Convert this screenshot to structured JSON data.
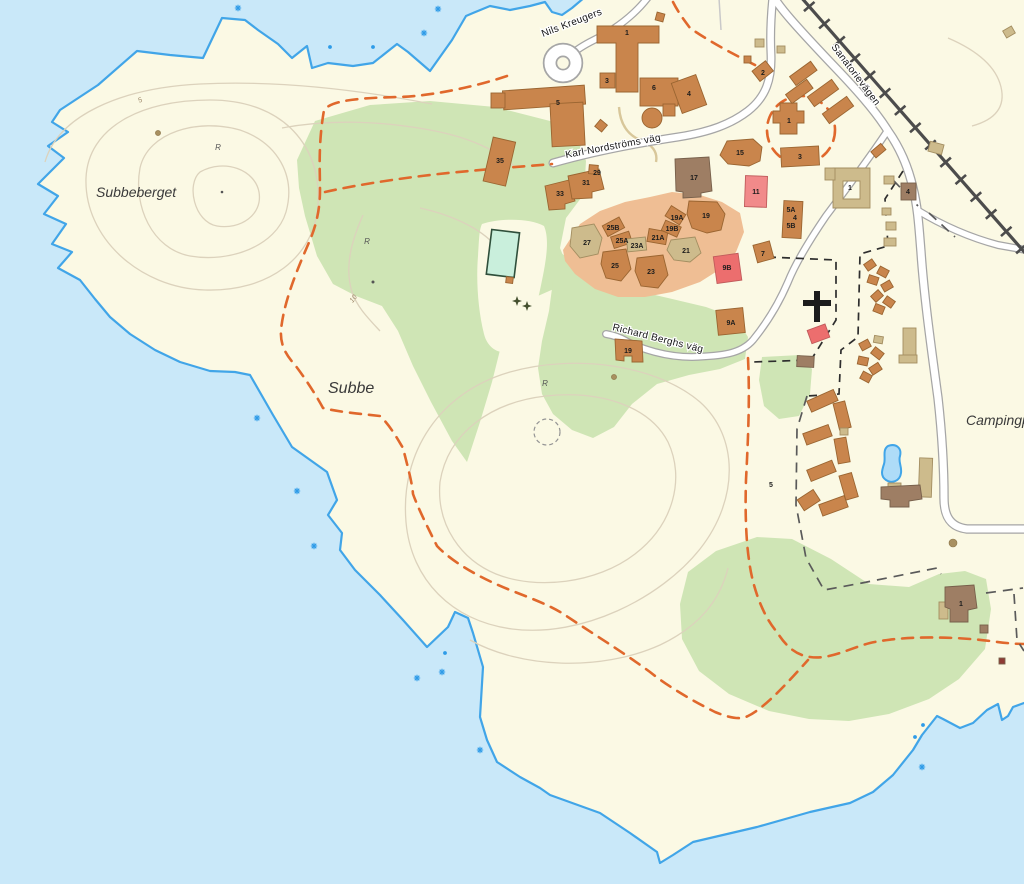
{
  "map": {
    "description": "Topographic town map of the Subbe peninsula with sanatorium area, camping ground and railway",
    "zoom_hint": "street-level"
  },
  "colors": {
    "water": "#C9E8F9",
    "land": "#FBF9E4",
    "green": "#CFE5B5",
    "residential_zone": "#EFBE94",
    "building_orange": "#C9854C",
    "building_orange_stroke": "#9A6531",
    "building_tan": "#CDBB8C",
    "building_tan_stroke": "#A38E61",
    "building_brown": "#9E7E64",
    "building_brown_stroke": "#77604B",
    "building_pink": "#F18A8A",
    "building_red": "#EC6E6E",
    "building_pink_stroke": "#C05B5B",
    "road_fill": "#FFFFFF",
    "road_casing": "#A6A6A6",
    "railway": "#4C4C4C",
    "trail": "#E0682C",
    "contour": "#DCD2BC",
    "coastline": "#41A5E8",
    "pool": "#C9EFDC",
    "pond": "#AEDCF8",
    "label": "#1C1C1C",
    "contour_label": "#9C8668"
  },
  "labels": {
    "places": [
      {
        "text": "Subbeberget",
        "x": 96,
        "y": 197,
        "big": false
      },
      {
        "text": "Subbe",
        "x": 328,
        "y": 393,
        "big": true
      },
      {
        "text": "Campingp",
        "x": 966,
        "y": 425,
        "big": false
      }
    ],
    "streets": [
      {
        "text": "Nils Kreugers",
        "x": 543,
        "y": 37,
        "rot": -21
      },
      {
        "text": "Karl Nordströms väg",
        "x": 566,
        "y": 158,
        "rot": -10.5
      },
      {
        "text": "Richard Berghs väg",
        "x": 612,
        "y": 330,
        "rot": 14
      },
      {
        "text": "Sanatorievägen",
        "x": 831,
        "y": 47,
        "rot": 53
      }
    ],
    "contour_labels": [
      {
        "text": "5",
        "x": 141,
        "y": 102,
        "rot": -25
      },
      {
        "text": "10",
        "x": 355,
        "y": 300,
        "rot": -52
      }
    ],
    "terrain_marks": [
      {
        "text": "R",
        "x": 218,
        "y": 150
      },
      {
        "text": "R",
        "x": 367,
        "y": 244
      },
      {
        "text": "R",
        "x": 545,
        "y": 386
      }
    ],
    "building_numbers": [
      {
        "t": "1",
        "x": 627,
        "y": 35
      },
      {
        "t": "6",
        "x": 654,
        "y": 90
      },
      {
        "t": "4",
        "x": 689,
        "y": 96
      },
      {
        "t": "5",
        "x": 558,
        "y": 105
      },
      {
        "t": "3",
        "x": 607,
        "y": 83
      },
      {
        "t": "35",
        "x": 500,
        "y": 163
      },
      {
        "t": "33",
        "x": 560,
        "y": 196
      },
      {
        "t": "31",
        "x": 586,
        "y": 185
      },
      {
        "t": "29",
        "x": 597,
        "y": 175
      },
      {
        "t": "17",
        "x": 694,
        "y": 180
      },
      {
        "t": "15",
        "x": 740,
        "y": 155
      },
      {
        "t": "11",
        "x": 756,
        "y": 194
      },
      {
        "t": "1",
        "x": 789,
        "y": 123
      },
      {
        "t": "3",
        "x": 800,
        "y": 159
      },
      {
        "t": "2",
        "x": 763,
        "y": 75
      },
      {
        "t": "27",
        "x": 587,
        "y": 245
      },
      {
        "t": "25B",
        "x": 613,
        "y": 230
      },
      {
        "t": "25A",
        "x": 622,
        "y": 243
      },
      {
        "t": "23A",
        "x": 637,
        "y": 248
      },
      {
        "t": "21A",
        "x": 658,
        "y": 240
      },
      {
        "t": "19A",
        "x": 677,
        "y": 220
      },
      {
        "t": "19B",
        "x": 672,
        "y": 231
      },
      {
        "t": "19",
        "x": 706,
        "y": 218
      },
      {
        "t": "21",
        "x": 686,
        "y": 253
      },
      {
        "t": "25",
        "x": 615,
        "y": 268
      },
      {
        "t": "23",
        "x": 651,
        "y": 274
      },
      {
        "t": "9B",
        "x": 727,
        "y": 270
      },
      {
        "t": "7",
        "x": 763,
        "y": 256
      },
      {
        "t": "5A",
        "x": 791,
        "y": 212
      },
      {
        "t": "4",
        "x": 795,
        "y": 220
      },
      {
        "t": "5B",
        "x": 791,
        "y": 228
      },
      {
        "t": "9A",
        "x": 731,
        "y": 325
      },
      {
        "t": "19",
        "x": 628,
        "y": 353
      },
      {
        "t": "4",
        "x": 908,
        "y": 194
      },
      {
        "t": "1",
        "x": 850,
        "y": 190
      },
      {
        "t": "1",
        "x": 961,
        "y": 606
      },
      {
        "t": "5",
        "x": 771,
        "y": 487
      }
    ]
  },
  "symbols": {
    "church": {
      "name": "church-cross",
      "x": 817,
      "y": 306
    },
    "water_stars": [
      {
        "x": 238,
        "y": 8
      },
      {
        "x": 438,
        "y": 9
      },
      {
        "x": 424,
        "y": 33
      },
      {
        "x": 257,
        "y": 418
      },
      {
        "x": 297,
        "y": 491
      },
      {
        "x": 314,
        "y": 546
      },
      {
        "x": 417,
        "y": 678
      },
      {
        "x": 442,
        "y": 672
      },
      {
        "x": 480,
        "y": 750
      },
      {
        "x": 922,
        "y": 767
      }
    ],
    "water_dots": [
      {
        "x": 330,
        "y": 47
      },
      {
        "x": 373,
        "y": 47
      },
      {
        "x": 445,
        "y": 653
      },
      {
        "x": 923,
        "y": 725
      },
      {
        "x": 915,
        "y": 737
      }
    ],
    "trees": [
      {
        "x": 517,
        "y": 301
      },
      {
        "x": 527,
        "y": 306
      }
    ]
  }
}
